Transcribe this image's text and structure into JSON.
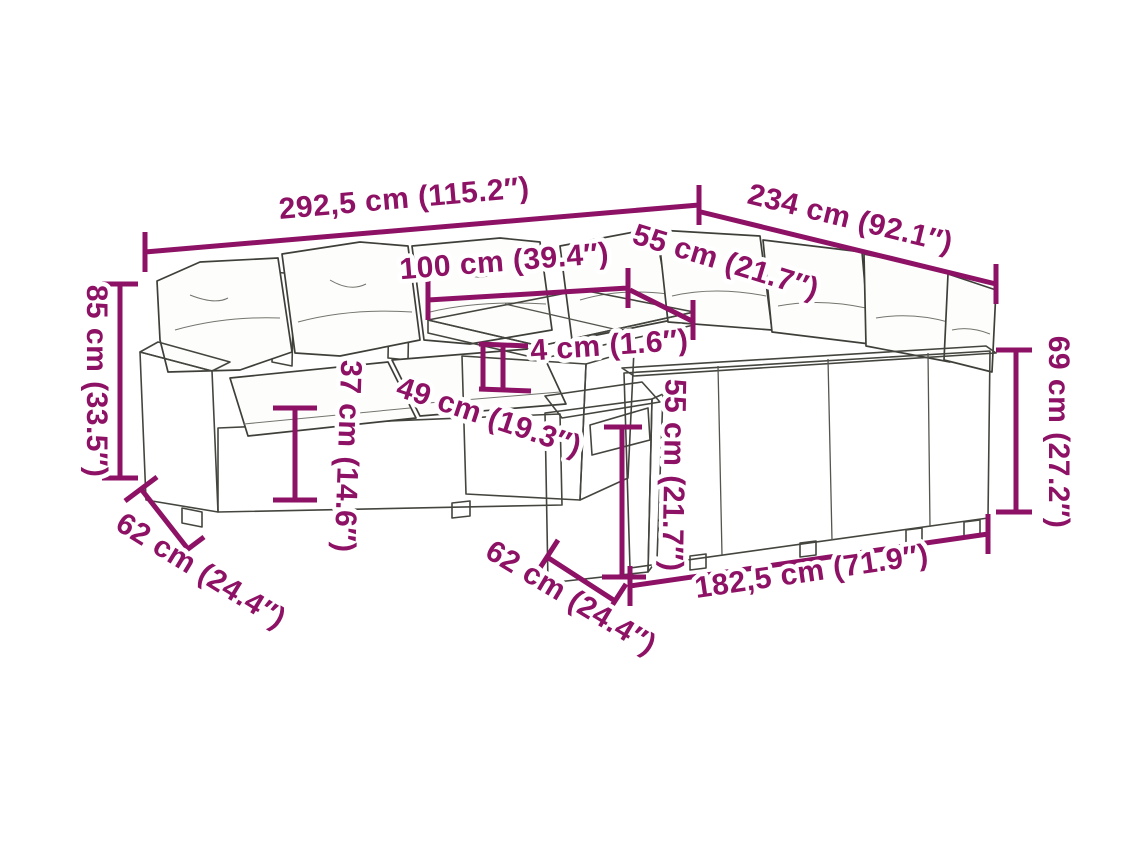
{
  "figure": {
    "type": "product-dimension-diagram",
    "subject": "poly rattan garden lounge set with cushions, table and footstool",
    "accent_color": "#8D1164",
    "background_color": "#ffffff"
  },
  "dimensions": [
    {
      "id": "overall-width",
      "label": "292,5 cm (115.2″)"
    },
    {
      "id": "overall-depth",
      "label": "234 cm (92.1″)"
    },
    {
      "id": "table-length",
      "label": "100 cm (39.4″)"
    },
    {
      "id": "table-depth",
      "label": "55 cm (21.7″)"
    },
    {
      "id": "back-height",
      "label": "85 cm (33.5″)"
    },
    {
      "id": "tabletop-thickness",
      "label": "4 cm (1.6″)"
    },
    {
      "id": "seat-height",
      "label": "37 cm (14.6″)"
    },
    {
      "id": "under-table-clearance",
      "label": "49 cm (19.3″)"
    },
    {
      "id": "stool-height",
      "label": "55 cm (21.7″)"
    },
    {
      "id": "arm-height",
      "label": "69 cm (27.2″)"
    },
    {
      "id": "seat-depth-left",
      "label": "62 cm (24.4″)"
    },
    {
      "id": "seat-depth-front",
      "label": "62 cm (24.4″)"
    },
    {
      "id": "right-section-length",
      "label": "182,5 cm (71.9″)"
    }
  ]
}
